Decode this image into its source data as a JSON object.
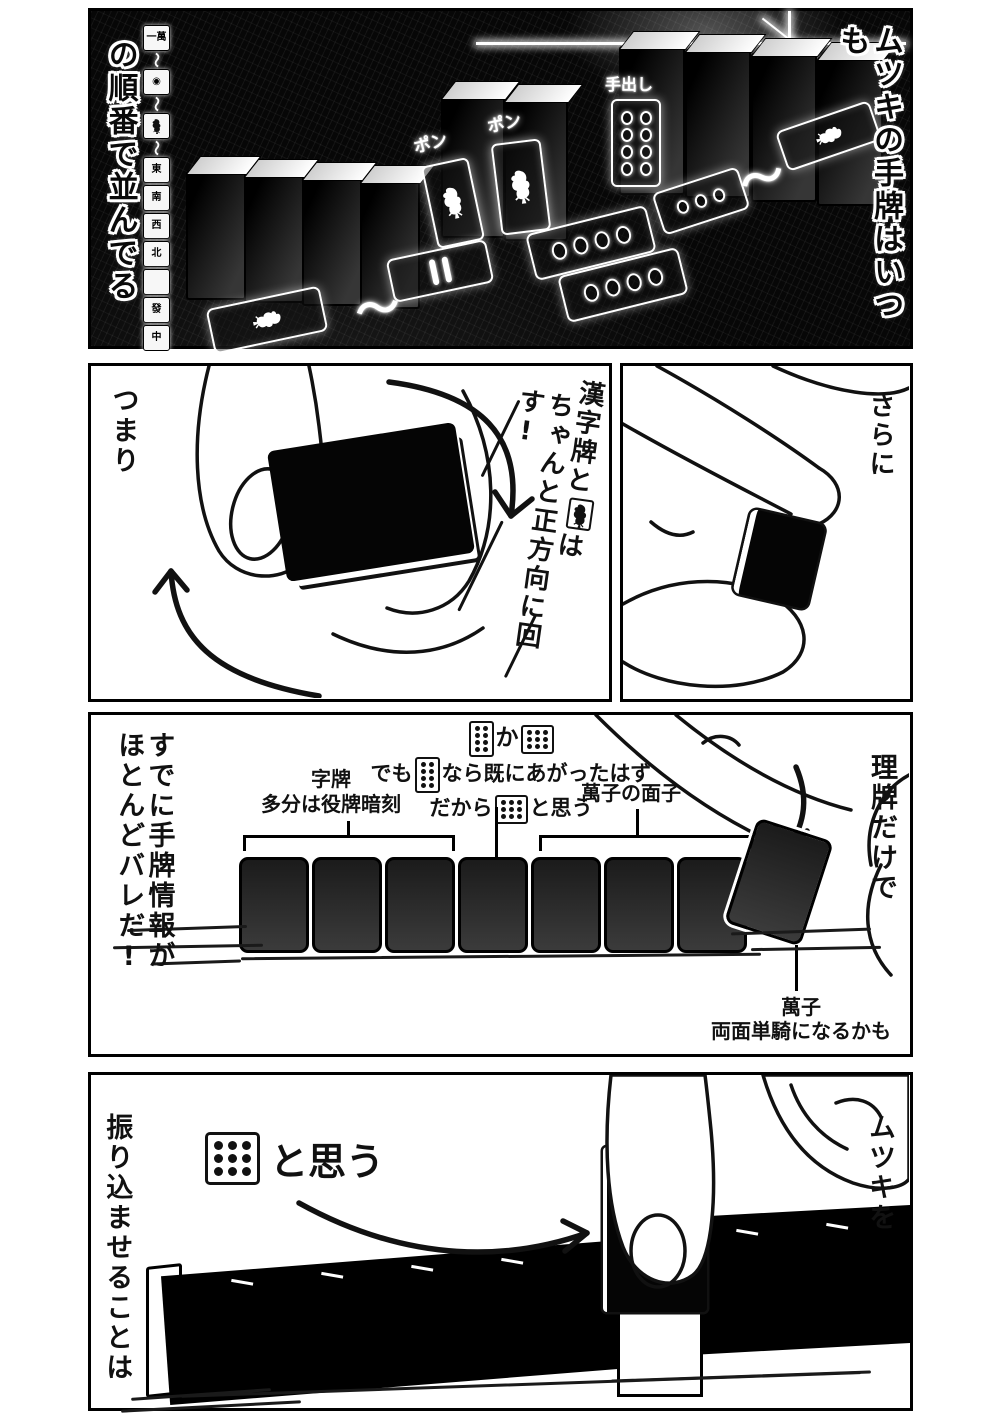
{
  "page": {
    "background": "#ffffff",
    "panel_border_color": "#000000"
  },
  "panel1": {
    "right_caption": "ムツキの手牌はいつも",
    "left_caption": "の順番で並んでる",
    "tile_strip": [
      {
        "kind": "tile",
        "label": "一萬"
      },
      {
        "kind": "wave",
        "label": "〜"
      },
      {
        "kind": "tile",
        "label": "◉"
      },
      {
        "kind": "wave",
        "label": "〜"
      },
      {
        "kind": "sou1",
        "label": ""
      },
      {
        "kind": "wave",
        "label": "〜"
      },
      {
        "kind": "tile",
        "label": "東"
      },
      {
        "kind": "tile",
        "label": "南"
      },
      {
        "kind": "tile",
        "label": "西"
      },
      {
        "kind": "tile",
        "label": "北"
      },
      {
        "kind": "tile",
        "label": ""
      },
      {
        "kind": "tile",
        "label": "發"
      },
      {
        "kind": "tile",
        "label": "中"
      }
    ],
    "call_label_1": "ポン",
    "call_label_2": "ポン",
    "tedashi_label": "手出し",
    "wave_glyph": "〜"
  },
  "panel2_left": {
    "corner_caption": "つまり",
    "caption_col1_before": "漢字牌と",
    "caption_col1_after": "は",
    "caption_col2": "ちゃんと正方向に回す!",
    "icon": "one-sou-bird"
  },
  "panel2_right": {
    "corner_caption": "さらに"
  },
  "panel3": {
    "left_caption_line1": "すでに手牌情報が",
    "left_caption_line2": "ほとんどバレだ!",
    "right_caption": "理牌だけで",
    "note_line1": {
      "tile_a_pins": "8",
      "mid": "か",
      "tile_b_pins": "9"
    },
    "note_line2": {
      "before": "でも",
      "tile_pins": "8",
      "after": "なら既にあがったはず"
    },
    "note_line3": {
      "before": "だから",
      "tile_pins": "9",
      "after": "と思う"
    },
    "group1_label_line1": "字牌",
    "group1_label_line2": "多分は役牌暗刻",
    "group2_label": "萬子の面子",
    "separated_tile_label_line1": "萬子",
    "separated_tile_label_line2": "両面単騎になるかも"
  },
  "panel4": {
    "right_caption": "ムツキを",
    "left_caption": "振り込ませることは",
    "think_tile_pins": "9",
    "think_caption": "と思う"
  }
}
